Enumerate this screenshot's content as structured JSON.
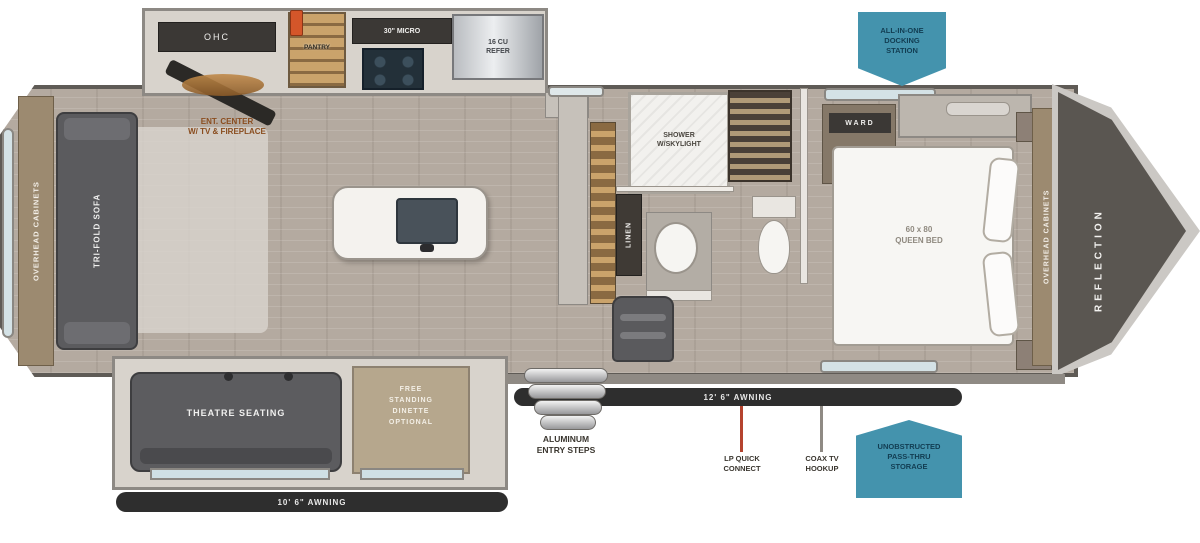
{
  "plan": {
    "brand_vertical": "REFLECTION",
    "badges": {
      "docking_station": [
        "ALL-IN-ONE",
        "DOCKING",
        "STATION"
      ],
      "pass_thru": [
        "UNOBSTRUCTED",
        "PASS-THRU",
        "STORAGE"
      ]
    },
    "kitchen": {
      "ohc": "OHC",
      "pantry": "PANTRY",
      "micro": "30\" MICRO",
      "refer": [
        "16 CU",
        "REFER"
      ],
      "ent_center": [
        "ENT. CENTER",
        "W/ TV & FIREPLACE"
      ]
    },
    "rear": {
      "overhead_cabinets": "OVERHEAD CABINETS",
      "sofa": "TRI-FOLD SOFA"
    },
    "bath": {
      "shower": [
        "SHOWER",
        "W/SKYLIGHT"
      ],
      "linen": "LINEN"
    },
    "bedroom": {
      "ward": "WARD",
      "bed": [
        "60 x 80",
        "QUEEN BED"
      ],
      "overhead_cabinets": "OVERHEAD CABINETS"
    },
    "living": {
      "theatre": "THEATRE SEATING",
      "dinette": [
        "FREE",
        "STANDING",
        "DINETTE",
        "OPTIONAL"
      ]
    },
    "exterior": {
      "steps": [
        "ALUMINUM",
        "ENTRY STEPS"
      ],
      "awning_main": "12' 6\" AWNING",
      "awning_slide": "10' 6\" AWNING",
      "lp": [
        "LP QUICK",
        "CONNECT"
      ],
      "coax": [
        "COAX TV",
        "HOOKUP"
      ]
    },
    "colors": {
      "badge_teal": "#4493ad",
      "awning_black": "#2e2e2e",
      "floor_wood": "#b4aaa0",
      "cabinet_tan": "#caa36b",
      "accent_orange": "#d4562a"
    }
  }
}
